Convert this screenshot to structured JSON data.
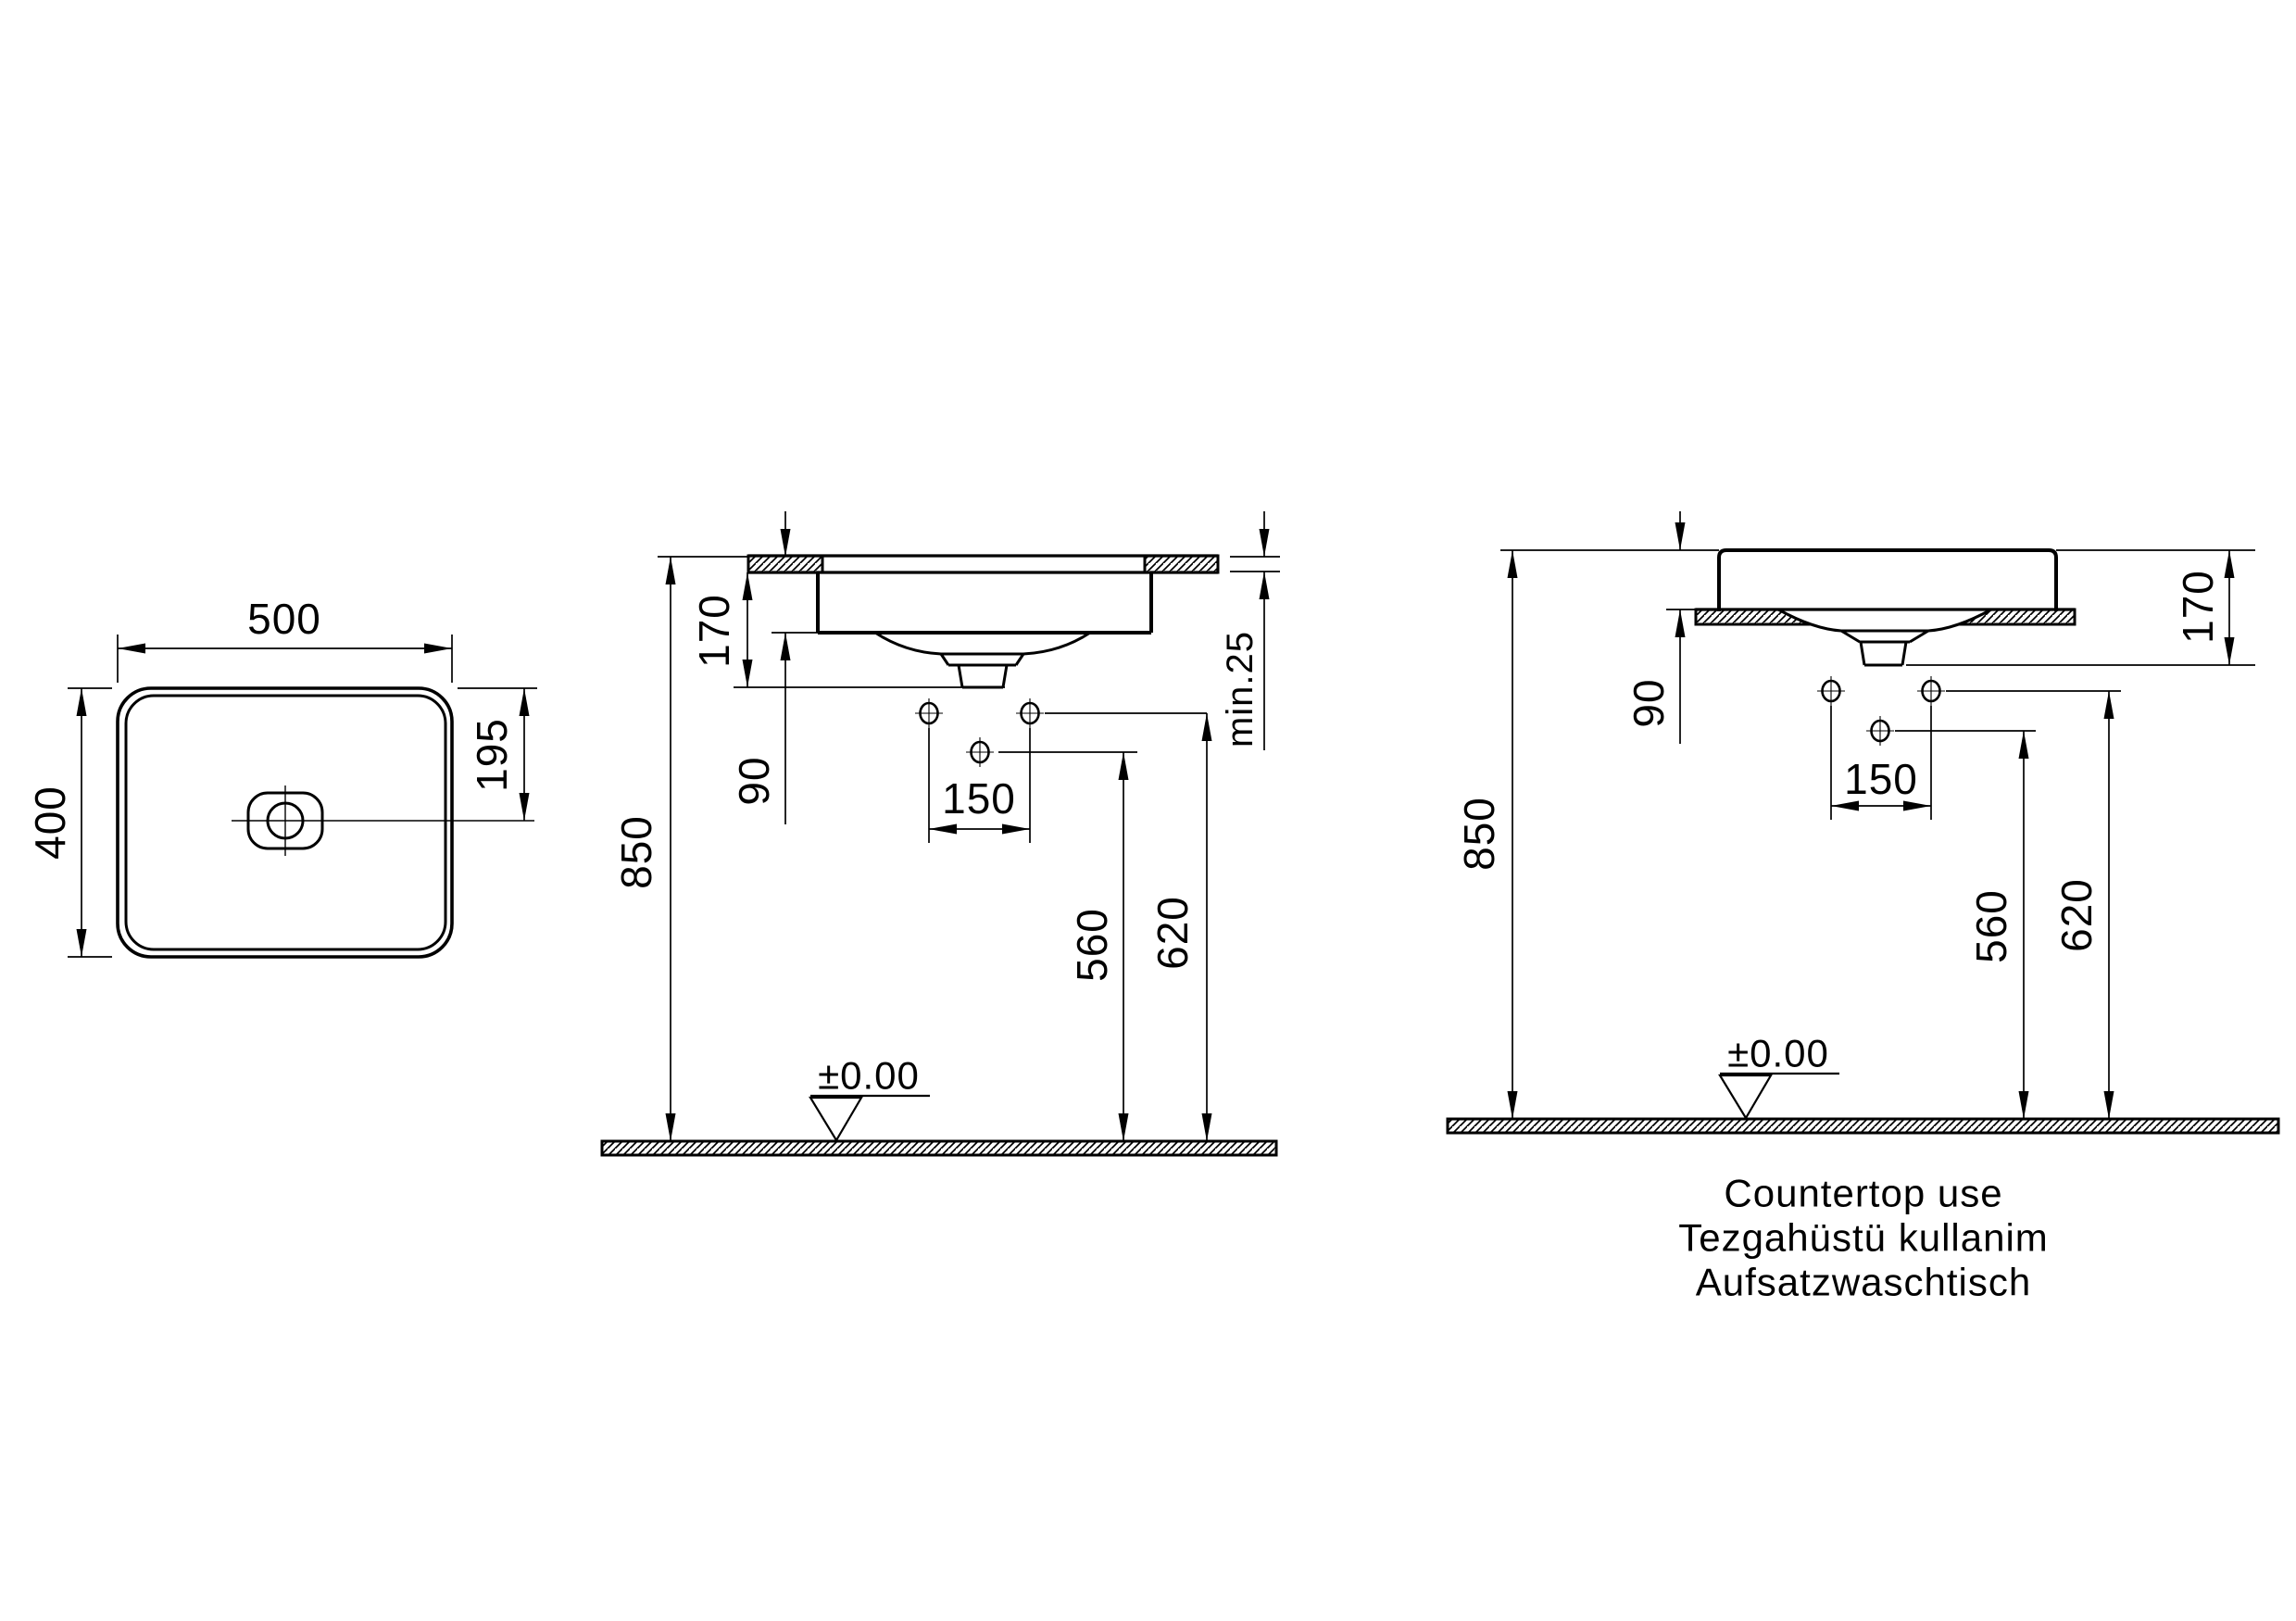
{
  "drawing_type": "technical-installation-drawing-washbasin",
  "colors": {
    "line": "#000000",
    "background": "#ffffff"
  },
  "plan": {
    "width_mm": "500",
    "depth_mm": "400",
    "drain_offset_mm": "195"
  },
  "semi": {
    "basin_height_mm": "170",
    "hole_offset_mm": "90",
    "rim_height_mm": "850",
    "tap_spacing_mm": "150",
    "mid_hole_height_mm": "560",
    "side_holes_height_mm": "620",
    "counter_thickness": "min.25",
    "datum": "±0.00"
  },
  "counter": {
    "basin_height_mm": "170",
    "above_counter_mm": "90",
    "rim_height_mm": "850",
    "tap_spacing_mm": "150",
    "mid_hole_height_mm": "560",
    "side_holes_height_mm": "620",
    "datum": "±0.00",
    "caption_line1": "Countertop use",
    "caption_line2": "Tezgahüstü kullanim",
    "caption_line3": "Aufsatzwaschtisch"
  }
}
